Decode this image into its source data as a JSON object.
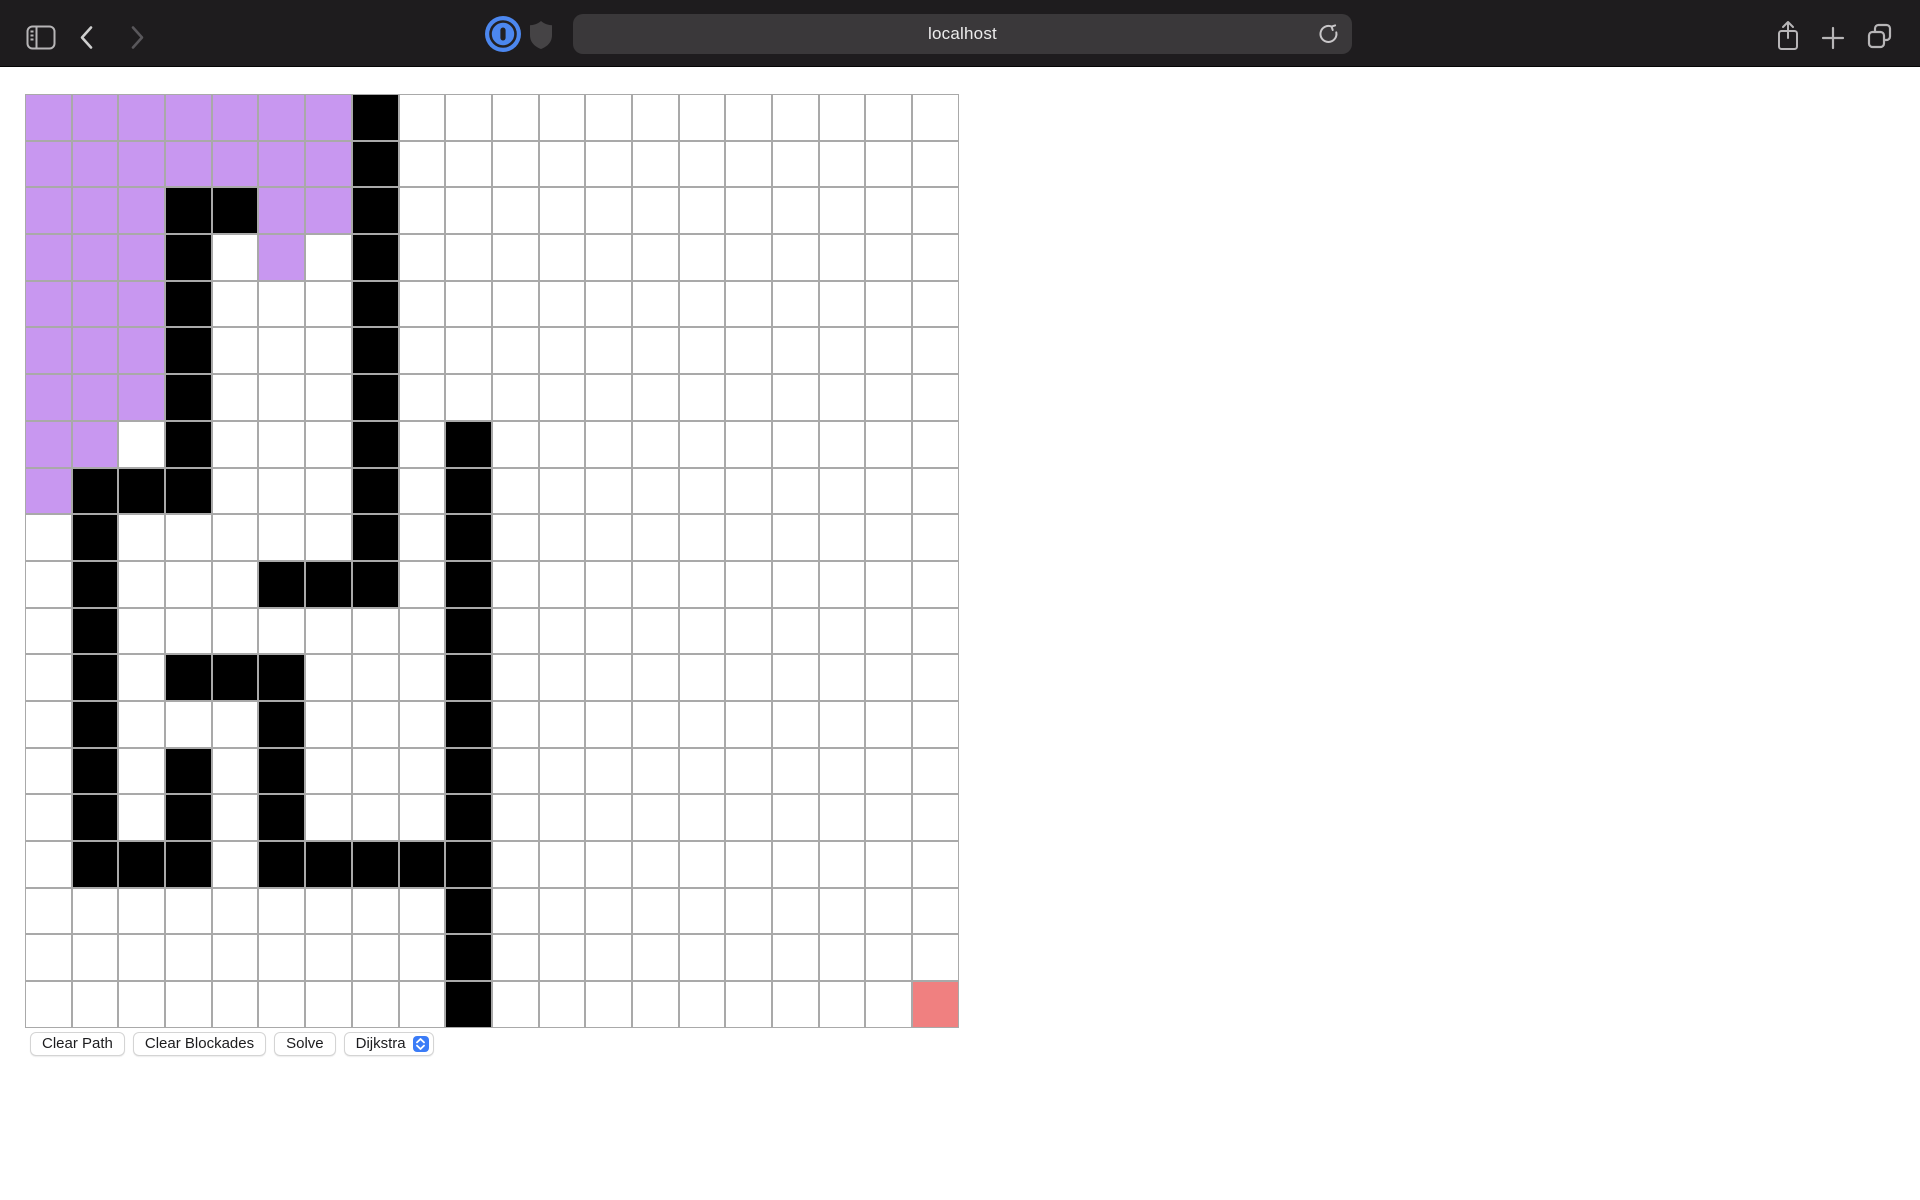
{
  "browser": {
    "url": "localhost",
    "toolbar": {
      "back_enabled": true,
      "forward_enabled": false
    }
  },
  "controls": {
    "clear_path_label": "Clear Path",
    "clear_blockades_label": "Clear Blockades",
    "solve_label": "Solve",
    "algorithm_selected": "Dijkstra"
  },
  "grid": {
    "rows_count": 20,
    "cols_count": 20,
    "cell_size_px": 46.7,
    "legend_colors": {
      "W": "#ffffff",
      "P": "#c897f0",
      "B": "#000000",
      "R": "#f08080"
    },
    "legend_semantics": {
      "W": "empty",
      "P": "visited",
      "B": "blockade",
      "R": "target"
    },
    "rows": [
      "PPPPPPPBWWWWWWWWWWWW",
      "PPPPPPPBWWWWWWWWWWWW",
      "PPPBBPPBWWWWWWWWWWWW",
      "PPPBWPWBWWWWWWWWWWWW",
      "PPPBWWWBWWWWWWWWWWWW",
      "PPPBWWWBWWWWWWWWWWWW",
      "PPPBWWWBWWWWWWWWWWWW",
      "PPWBWWWBWBWWWWWWWWWW",
      "PBBBWWWBWBWWWWWWWWWW",
      "WBWWWWWBWBWWWWWWWWWW",
      "WBWWWBBBWBWWWWWWWWWW",
      "WBWWWWWWWBWWWWWWWWWW",
      "WBWBBBWWWBWWWWWWWWWW",
      "WBWWWBWWWBWWWWWWWWWW",
      "WBWBWBWWWBWWWWWWWWWW",
      "WBWBWBWWWBWWWWWWWWWW",
      "WBBBWBBBBBWWWWWWWWWW",
      "WWWWWWWWWBWWWWWWWWWW",
      "WWWWWWWWWBWWWWWWWWWW",
      "WWWWWWWWWBWWWWWWWWWR"
    ]
  },
  "colors": {
    "toolbar_bg": "#1e1c1e",
    "urlbar_bg": "#3a383a",
    "grid_line": "#a9a9a9",
    "accent_blue": "#3b7cf7",
    "extension_blue": "#4c87ef"
  }
}
